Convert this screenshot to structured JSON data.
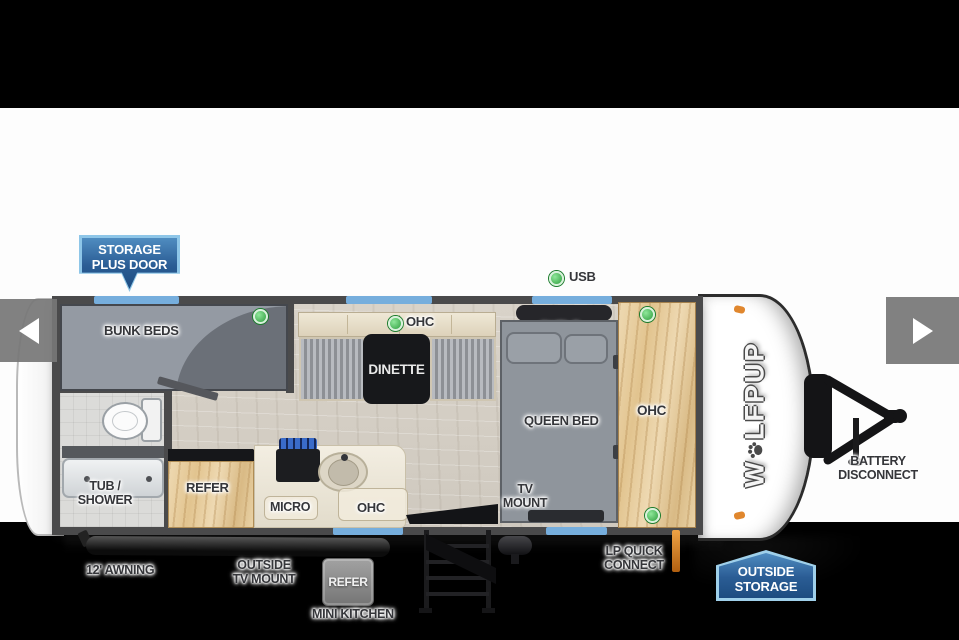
{
  "top": {
    "storage_badge_line1": "STORAGE",
    "storage_badge_line2": "PLUS DOOR",
    "usb_label": "USB"
  },
  "plan": {
    "bunk_beds": "BUNK BEDS",
    "dinette_ohc": "OHC",
    "dinette": "DINETTE",
    "shelf": "SHELF",
    "queen_bed": "QUEEN BED",
    "tv_mount_line1": "TV",
    "tv_mount_line2": "MOUNT",
    "front_ohc": "OHC",
    "tub_shower_line1": "TUB /",
    "tub_shower_line2": "SHOWER",
    "refer": "REFER",
    "micro": "MICRO",
    "kitchen_ohc": "OHC"
  },
  "exterior": {
    "awning": "12' AWNING",
    "outside_tv_line1": "OUTSIDE",
    "outside_tv_line2": "TV MOUNT",
    "mini_refer": "REFER",
    "mini_kitchen": "MINI KITCHEN",
    "lp_line1": "LP QUICK",
    "lp_line2": "CONNECT",
    "outside_storage_line1": "OUTSIDE",
    "outside_storage_line2": "STORAGE",
    "battery_line1": "BATTERY",
    "battery_line2": "DISCONNECT"
  },
  "logo": {
    "prefix": "W",
    "suffix": "LFPUP"
  },
  "colors": {
    "badge_blue_top": "#4f8cc0",
    "badge_blue_bottom": "#1d4c80",
    "badge_border": "#8ec6e8",
    "window_blue": "#76aedd",
    "green_indicator": "#3bb54a",
    "clearance_orange": "#e0872e",
    "wall_gray": "#4a4a4b"
  }
}
